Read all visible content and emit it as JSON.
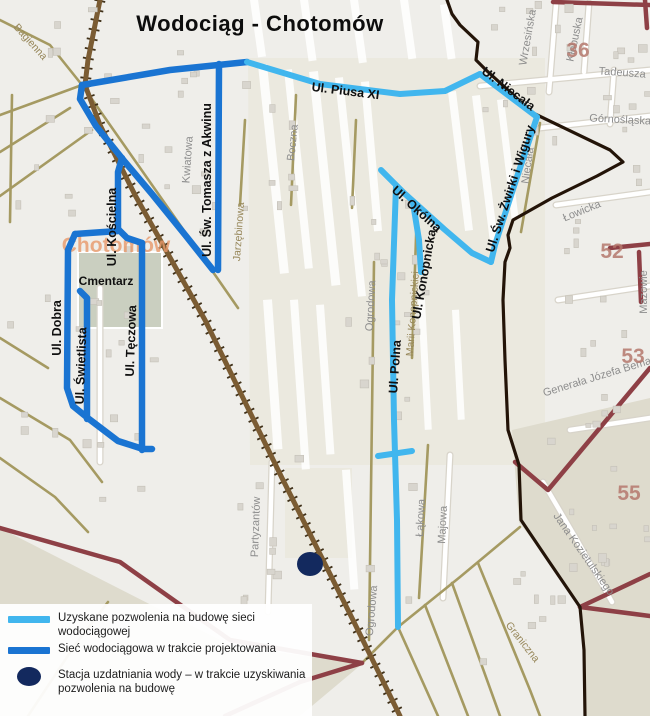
{
  "title": "Wodociąg  - Chotomów",
  "colors": {
    "obtained": "#41b6ee",
    "designed": "#1a74d2",
    "station": "#13295e",
    "background": "#efeeea",
    "panel": "#ebe9df",
    "shade": "#dedbcd",
    "cemetery": "#cacfc0",
    "building": "#d8d5ce",
    "building_edge": "#c4c0b7",
    "road_tan": "#a59a62",
    "road_maroon": "#8e4046",
    "railway": "#7b5c33",
    "railway_tick": "#40311a",
    "boundary": "#231408",
    "white_road": "#ffffff",
    "white_casing": "#d8d4ca"
  },
  "legend": {
    "items": [
      {
        "type": "obtained-line",
        "lines": [
          "Uzyskane pozwolenia na budowę sieci",
          "wodociągowej"
        ]
      },
      {
        "type": "designed-line",
        "lines": [
          "Sieć wodociągowa w trakcie projektowania",
          ""
        ]
      },
      {
        "type": "station-dot",
        "lines": [
          "Stacja uzdatniania wody – w trakcie uzyskiwania",
          "pozwolenia na budowę"
        ]
      }
    ]
  },
  "station": {
    "cx": 310,
    "cy": 564,
    "rx": 13,
    "ry": 12
  },
  "network": {
    "designed": [
      [
        [
          82,
          85
        ],
        [
          170,
          70
        ],
        [
          247,
          62
        ]
      ],
      [
        [
          82,
          85
        ],
        [
          80,
          99
        ],
        [
          96,
          126
        ],
        [
          125,
          162
        ],
        [
          152,
          194
        ],
        [
          186,
          236
        ],
        [
          213,
          270
        ]
      ],
      [
        [
          219,
          64
        ],
        [
          218,
          270
        ]
      ],
      [
        [
          122,
          158
        ],
        [
          118,
          172
        ],
        [
          118,
          229
        ]
      ],
      [
        [
          118,
          231
        ],
        [
          75,
          234
        ]
      ],
      [
        [
          75,
          234
        ],
        [
          68,
          250
        ],
        [
          67,
          388
        ],
        [
          73,
          406
        ],
        [
          89,
          419
        ],
        [
          118,
          441
        ],
        [
          143,
          449
        ],
        [
          152,
          449
        ]
      ],
      [
        [
          80,
          291
        ],
        [
          87,
          298
        ],
        [
          87,
          419
        ]
      ],
      [
        [
          118,
          229
        ],
        [
          127,
          238
        ],
        [
          142,
          243
        ]
      ],
      [
        [
          142,
          243
        ],
        [
          142,
          450
        ]
      ]
    ],
    "obtained": [
      [
        [
          247,
          62
        ],
        [
          320,
          84
        ],
        [
          400,
          94
        ],
        [
          445,
          91
        ],
        [
          480,
          74
        ]
      ],
      [
        [
          480,
          74
        ],
        [
          537,
          117
        ]
      ],
      [
        [
          537,
          117
        ],
        [
          516,
          180
        ],
        [
          495,
          245
        ],
        [
          491,
          262
        ]
      ],
      [
        [
          381,
          170
        ],
        [
          404,
          193
        ],
        [
          444,
          229
        ],
        [
          472,
          253
        ],
        [
          491,
          262
        ]
      ],
      [
        [
          413,
          203
        ],
        [
          419,
          240
        ],
        [
          421,
          272
        ]
      ],
      [
        [
          396,
          186
        ],
        [
          392,
          300
        ],
        [
          394,
          420
        ],
        [
          397,
          520
        ],
        [
          398,
          627
        ]
      ],
      [
        [
          378,
          456
        ],
        [
          412,
          451
        ]
      ]
    ]
  },
  "base": {
    "shade_polys": [
      {
        "pts": [
          [
            248,
            58
          ],
          [
            545,
            58
          ],
          [
            545,
            465
          ],
          [
            250,
            465
          ]
        ],
        "fill": "panel"
      },
      {
        "pts": [
          [
            285,
            468
          ],
          [
            352,
            468
          ],
          [
            352,
            558
          ],
          [
            285,
            558
          ]
        ],
        "fill": "panel"
      },
      {
        "pts": [
          [
            512,
            430
          ],
          [
            650,
            398
          ],
          [
            650,
            716
          ],
          [
            586,
            716
          ],
          [
            581,
            605
          ],
          [
            519,
            522
          ]
        ],
        "fill": "shade"
      },
      {
        "pts": [
          [
            0,
            528
          ],
          [
            230,
            645
          ],
          [
            362,
            664
          ],
          [
            300,
            716
          ],
          [
            0,
            716
          ]
        ],
        "fill": "shade"
      },
      {
        "pts": [
          [
            78,
            252
          ],
          [
            162,
            252
          ],
          [
            162,
            328
          ],
          [
            78,
            328
          ]
        ],
        "fill": "cemetery",
        "stroke": "#ffffff"
      }
    ],
    "field_strips": [
      [
        258,
        65,
        9,
        210,
        -6
      ],
      [
        284,
        70,
        8,
        200,
        -6
      ],
      [
        309,
        72,
        9,
        215,
        -6
      ],
      [
        335,
        78,
        8,
        220,
        -6
      ],
      [
        361,
        82,
        8,
        150,
        -5
      ],
      [
        448,
        92,
        8,
        140,
        -7
      ],
      [
        472,
        96,
        8,
        150,
        -7
      ],
      [
        497,
        100,
        7,
        120,
        -7
      ],
      [
        263,
        300,
        9,
        150,
        -4
      ],
      [
        290,
        300,
        8,
        170,
        -4
      ],
      [
        316,
        305,
        8,
        150,
        -4
      ],
      [
        342,
        470,
        8,
        120,
        -4
      ],
      [
        418,
        300,
        7,
        130,
        -3
      ],
      [
        452,
        310,
        7,
        110,
        -3
      ],
      [
        250,
        0,
        8,
        58,
        -8
      ],
      [
        300,
        0,
        8,
        62,
        -8
      ],
      [
        350,
        0,
        8,
        64,
        -8
      ],
      [
        400,
        0,
        8,
        60,
        -8
      ],
      [
        440,
        5,
        8,
        55,
        -8
      ]
    ],
    "white_roads": [
      [
        [
          556,
          5
        ],
        [
          549,
          92
        ]
      ],
      [
        [
          589,
          3
        ],
        [
          584,
          72
        ]
      ],
      [
        [
          480,
          86
        ],
        [
          650,
          70
        ]
      ],
      [
        [
          540,
          128
        ],
        [
          650,
          116
        ]
      ],
      [
        [
          614,
          70
        ],
        [
          610,
          124
        ]
      ],
      [
        [
          100,
          288
        ],
        [
          100,
          462
        ]
      ],
      [
        [
          272,
          462
        ],
        [
          268,
          612
        ]
      ],
      [
        [
          450,
          455
        ],
        [
          443,
          598
        ]
      ],
      [
        [
          543,
          482
        ],
        [
          577,
          540
        ],
        [
          612,
          602
        ]
      ],
      [
        [
          556,
          205
        ],
        [
          650,
          192
        ]
      ],
      [
        [
          558,
          300
        ],
        [
          650,
          286
        ]
      ],
      [
        [
          570,
          430
        ],
        [
          650,
          418
        ]
      ]
    ],
    "tan_roads": [
      [
        [
          0,
          20
        ],
        [
          50,
          45
        ],
        [
          82,
          85
        ]
      ],
      [
        [
          0,
          115
        ],
        [
          82,
          85
        ]
      ],
      [
        [
          0,
          152
        ],
        [
          70,
          108
        ]
      ],
      [
        [
          0,
          196
        ],
        [
          92,
          130
        ]
      ],
      [
        [
          82,
          85
        ],
        [
          213,
          272
        ],
        [
          238,
          308
        ]
      ],
      [
        [
          12,
          95
        ],
        [
          10,
          222
        ]
      ],
      [
        [
          0,
          338
        ],
        [
          48,
          368
        ]
      ],
      [
        [
          0,
          398
        ],
        [
          70,
          440
        ],
        [
          102,
          482
        ]
      ],
      [
        [
          0,
          458
        ],
        [
          55,
          497
        ],
        [
          88,
          532
        ]
      ],
      [
        [
          28,
          716
        ],
        [
          75,
          645
        ],
        [
          108,
          602
        ]
      ],
      [
        [
          245,
          120
        ],
        [
          240,
          205
        ]
      ],
      [
        [
          296,
          95
        ],
        [
          291,
          205
        ]
      ],
      [
        [
          356,
          120
        ],
        [
          352,
          208
        ]
      ],
      [
        [
          374,
          262
        ],
        [
          369,
          640
        ]
      ],
      [
        [
          428,
          445
        ],
        [
          419,
          598
        ]
      ],
      [
        [
          417,
          208
        ],
        [
          412,
          358
        ]
      ],
      [
        [
          540,
          123
        ],
        [
          521,
          232
        ]
      ],
      [
        [
          362,
          663
        ],
        [
          398,
          627
        ],
        [
          460,
          577
        ],
        [
          520,
          527
        ]
      ],
      [
        [
          398,
          627
        ],
        [
          438,
          716
        ]
      ],
      [
        [
          425,
          605
        ],
        [
          468,
          716
        ]
      ],
      [
        [
          452,
          583
        ],
        [
          500,
          716
        ]
      ],
      [
        [
          478,
          563
        ],
        [
          530,
          690
        ],
        [
          540,
          716
        ]
      ]
    ],
    "maroon_roads": [
      [
        [
          553,
          2
        ],
        [
          650,
          5
        ]
      ],
      [
        [
          645,
          0
        ],
        [
          647,
          28
        ]
      ],
      [
        [
          610,
          248
        ],
        [
          650,
          244
        ]
      ],
      [
        [
          639,
          252
        ],
        [
          641,
          302
        ]
      ],
      [
        [
          515,
          462
        ],
        [
          548,
          490
        ],
        [
          650,
          368
        ]
      ],
      [
        [
          580,
          607
        ],
        [
          650,
          574
        ]
      ],
      [
        [
          580,
          607
        ],
        [
          650,
          616
        ]
      ],
      [
        [
          225,
          716
        ],
        [
          300,
          682
        ],
        [
          362,
          663
        ]
      ],
      [
        [
          0,
          528
        ],
        [
          120,
          562
        ],
        [
          230,
          640
        ],
        [
          362,
          663
        ]
      ]
    ],
    "railway": [
      [
        100,
        0
      ],
      [
        88,
        60
      ],
      [
        85,
        85
      ],
      [
        100,
        125
      ],
      [
        135,
        195
      ],
      [
        205,
        320
      ],
      [
        282,
        478
      ],
      [
        352,
        618
      ],
      [
        400,
        716
      ]
    ],
    "boundary": [
      [
        447,
        0
      ],
      [
        452,
        14
      ],
      [
        460,
        25
      ],
      [
        478,
        42
      ],
      [
        476,
        60
      ],
      [
        486,
        70
      ],
      [
        533,
        113
      ],
      [
        610,
        150
      ],
      [
        623,
        162
      ],
      [
        597,
        176
      ],
      [
        552,
        198
      ],
      [
        513,
        220
      ],
      [
        508,
        235
      ],
      [
        510,
        248
      ],
      [
        505,
        262
      ],
      [
        503,
        300
      ],
      [
        505,
        360
      ],
      [
        508,
        430
      ],
      [
        519,
        465
      ],
      [
        521,
        520
      ],
      [
        548,
        560
      ],
      [
        580,
        607
      ],
      [
        584,
        650
      ],
      [
        585,
        716
      ]
    ],
    "building_clusters": [
      {
        "x": 0,
        "y": 0,
        "w": 230,
        "h": 250,
        "n": 26,
        "seed": 7
      },
      {
        "x": 480,
        "y": 0,
        "w": 165,
        "h": 150,
        "n": 22,
        "seed": 11
      },
      {
        "x": 545,
        "y": 155,
        "w": 100,
        "h": 270,
        "n": 16,
        "seed": 13
      },
      {
        "x": 520,
        "y": 430,
        "w": 125,
        "h": 170,
        "n": 14,
        "seed": 17
      },
      {
        "x": 5,
        "y": 255,
        "w": 150,
        "h": 250,
        "n": 18,
        "seed": 19
      },
      {
        "x": 230,
        "y": 75,
        "w": 80,
        "h": 140,
        "n": 8,
        "seed": 23
      },
      {
        "x": 235,
        "y": 455,
        "w": 70,
        "h": 150,
        "n": 9,
        "seed": 29
      },
      {
        "x": 345,
        "y": 195,
        "w": 80,
        "h": 420,
        "n": 20,
        "seed": 31
      },
      {
        "x": 480,
        "y": 560,
        "w": 60,
        "h": 120,
        "n": 5,
        "seed": 37
      }
    ]
  },
  "labels": {
    "place": [
      {
        "text": "Chotomów",
        "x": 116,
        "y": 252,
        "rot": 0
      }
    ],
    "network_streets": [
      {
        "text": "Ul. Piusa XI",
        "x": 345,
        "y": 95,
        "rot": 7
      },
      {
        "text": "Ul. Niecała",
        "x": 506,
        "y": 92,
        "rot": 37
      },
      {
        "text": "Ul. Św. Żwirki i Wigury",
        "x": 514,
        "y": 190,
        "rot": -72
      },
      {
        "text": "Ul. Okólna",
        "x": 414,
        "y": 212,
        "rot": 42
      },
      {
        "text": "Ul. Konopnicka",
        "x": 428,
        "y": 275,
        "rot": -80
      },
      {
        "text": "Ul. Polna",
        "x": 399,
        "y": 367,
        "rot": -86
      },
      {
        "text": "Ul. Św. Tomasza z Akwinu",
        "x": 211,
        "y": 180,
        "rot": -90
      },
      {
        "text": "Ul. Kościelna",
        "x": 116,
        "y": 227,
        "rot": -90
      },
      {
        "text": "Ul. Dobra",
        "x": 61,
        "y": 328,
        "rot": -90
      },
      {
        "text": "Ul. Świetlista",
        "x": 85,
        "y": 366,
        "rot": -88
      },
      {
        "text": "Ul. Tęczowa",
        "x": 135,
        "y": 341,
        "rot": -88
      }
    ],
    "poi": [
      {
        "text": "Cmentarz",
        "x": 106,
        "y": 285,
        "rot": 0
      }
    ],
    "background_streets_gray": [
      {
        "text": "Wrzesińska",
        "x": 531,
        "y": 38,
        "rot": -80
      },
      {
        "text": "Kłobuska",
        "x": 578,
        "y": 40,
        "rot": -78
      },
      {
        "text": "Tadeusza",
        "x": 622,
        "y": 76,
        "rot": 4
      },
      {
        "text": "Górnośląska",
        "x": 620,
        "y": 123,
        "rot": 3
      },
      {
        "text": "Niecała",
        "x": 531,
        "y": 166,
        "rot": -82
      },
      {
        "text": "Łowicka",
        "x": 583,
        "y": 214,
        "rot": -22
      },
      {
        "text": "Mazowie",
        "x": 647,
        "y": 292,
        "rot": -90
      },
      {
        "text": "Generała Józefa Bema",
        "x": 598,
        "y": 380,
        "rot": -17
      },
      {
        "text": "Jana Kozietulskiego",
        "x": 581,
        "y": 556,
        "rot": 55
      },
      {
        "text": "Partyzantów",
        "x": 259,
        "y": 527,
        "rot": -88
      },
      {
        "text": "Kwiatowa",
        "x": 191,
        "y": 160,
        "rot": -86
      },
      {
        "text": "Boczna",
        "x": 296,
        "y": 143,
        "rot": -84
      },
      {
        "text": "Ogrodowa",
        "x": 374,
        "y": 306,
        "rot": -87
      },
      {
        "text": "Ogrodowa",
        "x": 375,
        "y": 611,
        "rot": -85
      },
      {
        "text": "Łąkowa",
        "x": 424,
        "y": 518,
        "rot": -87
      },
      {
        "text": "Majowa",
        "x": 446,
        "y": 525,
        "rot": -87
      }
    ],
    "background_streets_tan": [
      {
        "text": "Bagienna",
        "x": 28,
        "y": 44,
        "rot": 48
      },
      {
        "text": "Jarzębinowa",
        "x": 242,
        "y": 232,
        "rot": -86
      },
      {
        "text": "Marii Konopnickiej",
        "x": 416,
        "y": 314,
        "rot": -86
      },
      {
        "text": "Graniczna",
        "x": 520,
        "y": 644,
        "rot": 52
      }
    ],
    "plot_numbers": [
      {
        "text": "36",
        "x": 578,
        "y": 57,
        "rot": 0
      },
      {
        "text": "52",
        "x": 612,
        "y": 258,
        "rot": 0
      },
      {
        "text": "53",
        "x": 633,
        "y": 363,
        "rot": 0
      },
      {
        "text": "55",
        "x": 629,
        "y": 500,
        "rot": 0
      }
    ]
  }
}
